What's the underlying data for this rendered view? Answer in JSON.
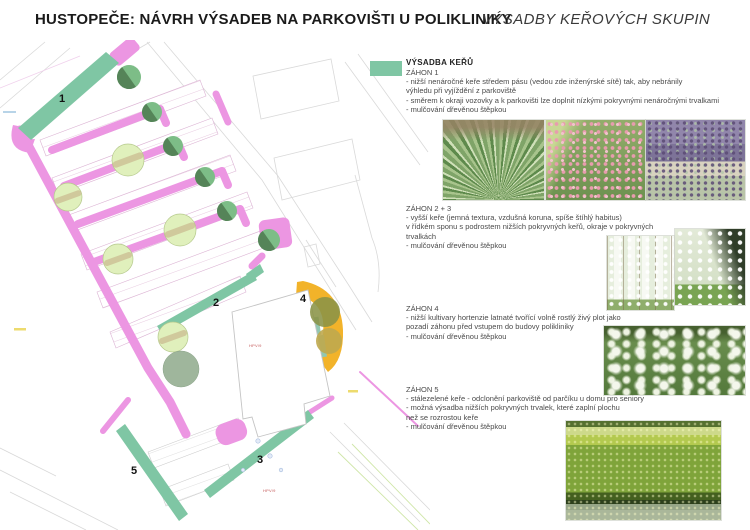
{
  "header": {
    "title": "HUSTOPEČE: NÁVRH VÝSADEB NA PARKOVIŠTI U POLIKLINIKY",
    "subtitle": "VÝSADBY KEŘOVÝCH SKUPIN"
  },
  "legend": {
    "label": "VÝSADBA KEŘŮ",
    "swatch_color": "#7fc6a4"
  },
  "sections": [
    {
      "heading": "ZÁHON 1",
      "lines": [
        "- nižší nenáročné keře středem pásu (vedou zde inženýrské sítě) tak, aby nebránily",
        "výhledu při vyjíždění z parkoviště",
        "- směrem k okraji vozovky a k parkovišti lze doplnit nízkými pokryvnými nenáročnými trvalkami",
        "- mulčování dřevěnou štěpkou"
      ]
    },
    {
      "heading": "ZÁHON 2 + 3",
      "lines": [
        "- vyšší keře (jemná textura, vzdušná koruna, spíše štíhlý habitus)",
        " v řídkém sponu s podrostem nižších pokryvných keřů, okraje v pokryvných",
        "trvalkách",
        "- mulčování dřevěnou štěpkou"
      ]
    },
    {
      "heading": "ZÁHON 4",
      "lines": [
        "- nižší kultivary hortenzie latnaté tvořící volně rostlý živý plot jako",
        "pozadí záhonu před vstupem do budovy polikliniky",
        "- mulčování dřevěnou štěpkou"
      ]
    },
    {
      "heading": "ZÁHON 5",
      "lines": [
        "- stálezelené keře - odclonění parkoviště od parčíku u domu pro seniory",
        "- možná výsadba nižších pokryvných trvalek, které zaplní plochu",
        "než se rozrostou keře",
        "- mulčování dřevěnou štěpkou"
      ]
    }
  ],
  "plan": {
    "bed_labels": [
      "1",
      "2",
      "3",
      "4",
      "5"
    ],
    "parcel_labels": [
      "HPV/9",
      "HPV/9"
    ],
    "colors": {
      "bed": "#7fc6a4",
      "strip": "#ec96e2",
      "accent_yellow": "#f2b32a",
      "tree_dark": "#7dbd87",
      "tree_light": "#e0f0bc",
      "tree_grey": "#9fb69c"
    }
  },
  "photos": {
    "row1": [
      "ornamental-grass",
      "pink-flowering-shrub",
      "lavender-shrubs"
    ],
    "row2": [
      "white-blossom-shrub-rows",
      "white-blossom-shrub-lawn"
    ],
    "row3": [
      "white-hydrangea-hedge"
    ],
    "row4": [
      "evergreen-hedge"
    ]
  }
}
